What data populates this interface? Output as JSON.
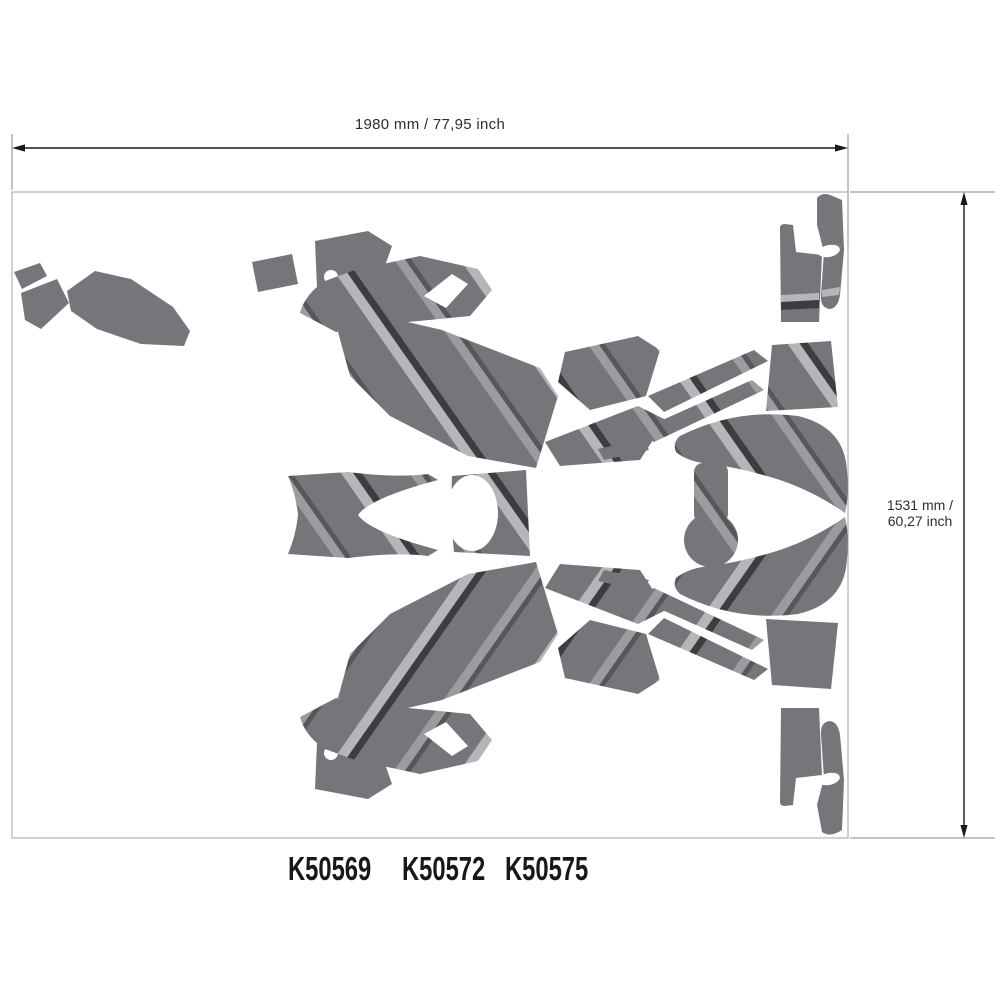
{
  "diagram": {
    "sheet": {
      "width_label": "1980 mm / 77,95 inch",
      "height_label_line1": "1531 mm /",
      "height_label_line2": "60,27 inch"
    },
    "part_numbers": [
      "K50569",
      "K50572",
      "K50575"
    ],
    "colors": {
      "decal_base": "#76767a",
      "stripe_light": "#b6b6ba",
      "stripe_mid": "#9c9ca0",
      "stripe_dark": "#3d3d40",
      "sheet_border": "#a0a0a0",
      "dimension_line": "#1a1a1a",
      "extension_line": "#8a8a8a",
      "label_text": "#2d2d2d",
      "part_number_text": "#181818"
    }
  }
}
